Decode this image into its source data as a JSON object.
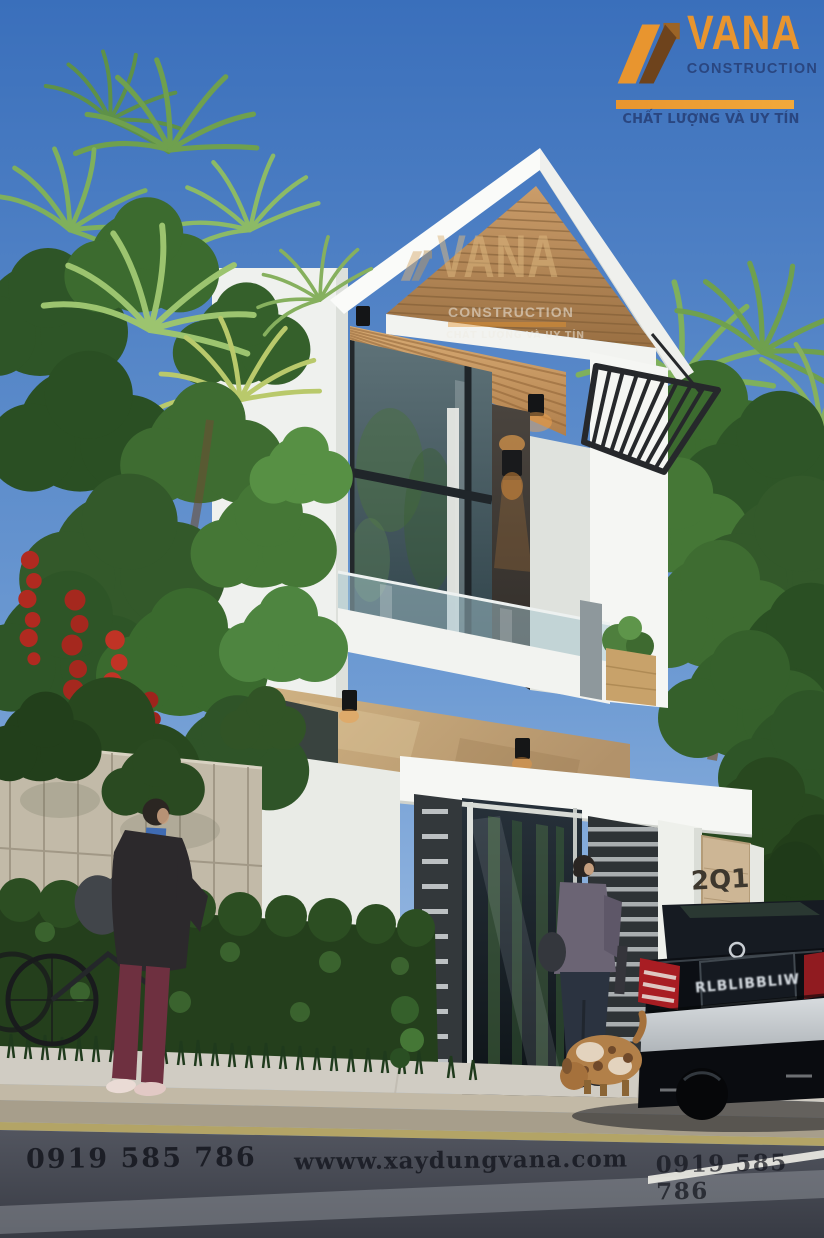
{
  "meta": {
    "width": 824,
    "height": 1238,
    "type": "architectural exterior render"
  },
  "branding": {
    "logo": {
      "name": "VANA",
      "subtitle": "CONSTRUCTION",
      "tagline": "CHẤT LƯỢNG VÀ UY TÍN"
    },
    "watermark": {
      "name": "VANA",
      "subtitle": "CONSTRUCTION",
      "tagline": "CHẤT LƯỢNG VÀ UY TÍN"
    }
  },
  "footer": {
    "phone_left": "0919 585 786",
    "website": "wwww.xaydungvana.com",
    "phone_right": "0919 585 786"
  },
  "scene": {
    "address_plaque": {
      "line1": "2Q1-",
      "line2": "8RUJ"
    },
    "car": {
      "license_plate": "RLBLIBBLIW"
    },
    "palette": {
      "logo_orange": "#E8952F",
      "logo_navy": "#2A4680",
      "sky_top": "#3A6FBB",
      "sky_bottom": "#A7C4E7",
      "wall_white": "#F5F6F3",
      "wood": "#C89A67",
      "stone_band": "#C4A878",
      "gate_dark": "#30353A",
      "foliage_green": "#3C6B2F",
      "flower_red": "#B02A20",
      "road_asphalt": "#464953",
      "curb_line_yellow": "#B5A158",
      "taillight_red": "#A81D23"
    }
  }
}
